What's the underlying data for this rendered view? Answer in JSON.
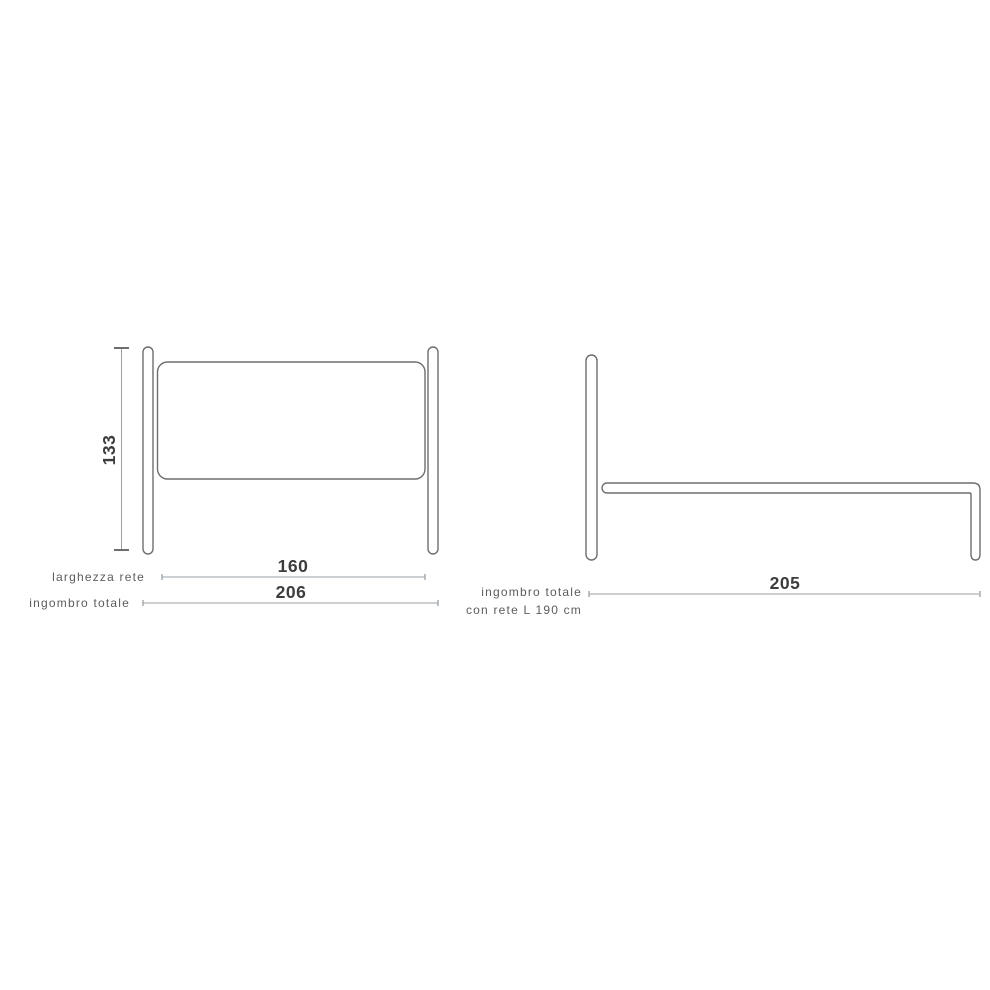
{
  "front_view": {
    "height": {
      "value": "133"
    },
    "dims": [
      {
        "label": "larghezza rete",
        "value": "160"
      },
      {
        "label": "ingombro totale",
        "value": "206"
      }
    ]
  },
  "side_view": {
    "dim": {
      "label_line1": "ingombro totale",
      "label_line2": "con rete L 190 cm",
      "value": "205"
    }
  },
  "colors": {
    "background": "#ffffff",
    "outline": "#6e6e6e",
    "dimension_line": "#9ba0a4",
    "dimension_text": "#3d3d3d",
    "label_text": "#5c5c5c"
  }
}
